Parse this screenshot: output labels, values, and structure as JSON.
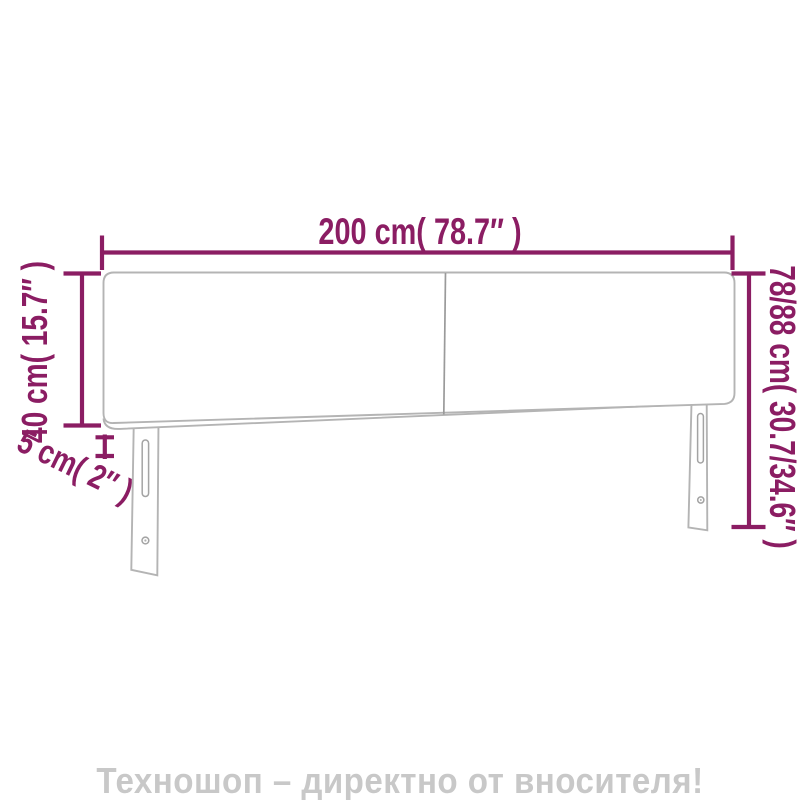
{
  "diagram": {
    "labels": {
      "width": "200 cm( 78.7″ )",
      "panel_height": "40 cm( 15.7″ )",
      "leg_thickness": "5 cm( 2″ )",
      "total_height": "78/88 cm( 30.7/34.6″ )"
    }
  },
  "watermark": {
    "text": "Техношоп – директно от вносителя!"
  },
  "colors": {
    "dimension": "#8b1d63",
    "outline": "#b4b4b4",
    "divider": "#9a9a9a",
    "hardware": "#a3a3a3",
    "watermark": "#c8c8c8",
    "background": "#ffffff"
  }
}
